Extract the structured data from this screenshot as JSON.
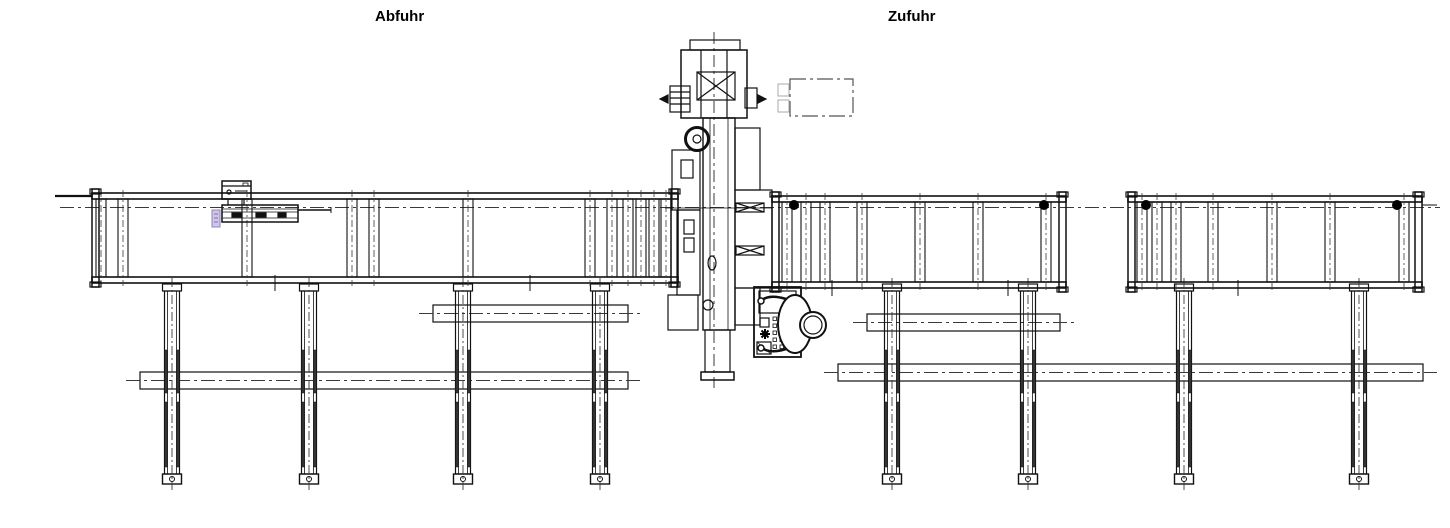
{
  "labels": {
    "outfeed": "Abfuhr",
    "infeed": "Zufuhr"
  },
  "colors": {
    "line": "#111111",
    "centerline": "#3a3a3a",
    "tag": "#cfc6e8",
    "datum_dot": "#000000",
    "background": "#ffffff"
  }
}
